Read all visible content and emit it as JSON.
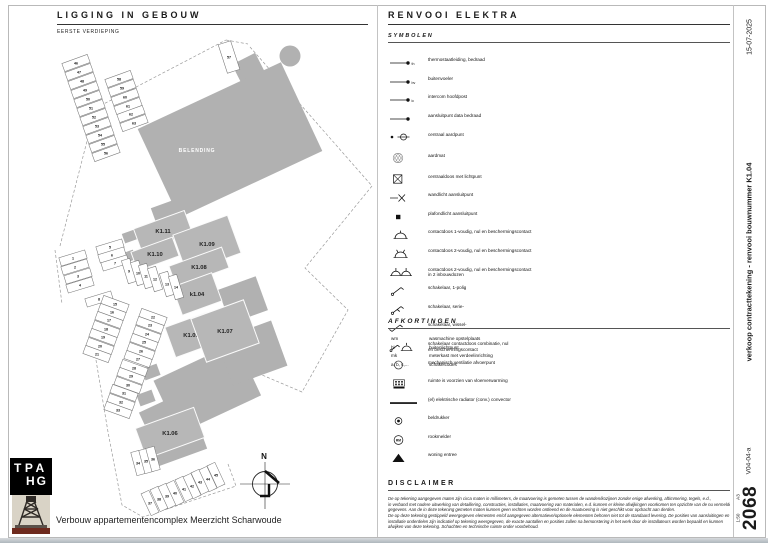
{
  "sheet": {
    "date": "15-07-2025",
    "doc_title": "verkoop contracttekening - renvooi bouwnummer K1.04",
    "version": "V04-04-a",
    "number": "2068",
    "scale": "1:50",
    "paper": "A3",
    "project_title": "Verbouw appartementencomplex Meerzicht Scharwoude",
    "logo_lines": [
      "TPA",
      "HG"
    ]
  },
  "plan": {
    "title": "LIGGING IN GEBOUW",
    "subtitle": "EERSTE VERDIEPING",
    "belending": "BELENDING",
    "north_label": "N",
    "units": [
      {
        "label": "K1.11",
        "x": 163,
        "y": 231,
        "w": 54,
        "h": 24,
        "r": -20
      },
      {
        "label": "K1.09",
        "x": 207,
        "y": 244,
        "w": 58,
        "h": 40,
        "r": -20
      },
      {
        "label": "K1.10",
        "x": 155,
        "y": 254,
        "w": 44,
        "h": 20,
        "r": -20
      },
      {
        "label": "K1.08",
        "x": 199,
        "y": 267,
        "w": 56,
        "h": 22,
        "r": -20
      },
      {
        "label": "k1.04",
        "x": 197,
        "y": 294,
        "w": 42,
        "h": 30,
        "r": -20
      },
      {
        "label": "K1.05",
        "x": 191,
        "y": 335,
        "w": 44,
        "h": 32,
        "r": -20
      },
      {
        "label": "K1.07",
        "x": 225,
        "y": 331,
        "w": 56,
        "h": 46,
        "r": -20
      },
      {
        "label": "K1.06",
        "x": 170,
        "y": 433,
        "w": 62,
        "h": 32,
        "r": -20
      }
    ],
    "stalls": [
      [
        "46",
        76,
        63,
        -20
      ],
      [
        "47",
        79,
        72,
        -20
      ],
      [
        "48",
        82,
        81,
        -20
      ],
      [
        "49",
        85,
        90,
        -20
      ],
      [
        "50",
        88,
        99,
        -20
      ],
      [
        "51",
        91,
        108,
        -20
      ],
      [
        "52",
        94,
        117,
        -20
      ],
      [
        "53",
        97,
        126,
        -20
      ],
      [
        "54",
        100,
        135,
        -20
      ],
      [
        "55",
        103,
        144,
        -20
      ],
      [
        "56",
        106,
        153,
        -20
      ],
      [
        "57",
        229,
        57,
        72,
        30,
        13
      ],
      [
        "58",
        119,
        79,
        -20
      ],
      [
        "59",
        122,
        88,
        -20
      ],
      [
        "60",
        125,
        97,
        -20
      ],
      [
        "61",
        128,
        106,
        -20
      ],
      [
        "62",
        131,
        114,
        -20
      ],
      [
        "63",
        134,
        123,
        -20
      ],
      [
        "1",
        73,
        258,
        -17
      ],
      [
        "2",
        75,
        267,
        -17
      ],
      [
        "3",
        78,
        276,
        -17
      ],
      [
        "4",
        80,
        285,
        -17
      ],
      [
        "5",
        110,
        247,
        -17
      ],
      [
        "6",
        112,
        255,
        -17
      ],
      [
        "7",
        115,
        263,
        -17
      ],
      [
        "8",
        99,
        299,
        -17
      ],
      [
        "9",
        129,
        271,
        73,
        24,
        8.6
      ],
      [
        "10",
        138,
        273,
        73,
        24,
        8.6
      ],
      [
        "11",
        146,
        276,
        73,
        24,
        8.6
      ],
      [
        "12",
        155,
        279,
        73,
        24,
        8.6
      ],
      [
        "13",
        167,
        284,
        73,
        24,
        8.6
      ],
      [
        "14",
        176,
        287,
        73,
        24,
        8.6
      ],
      [
        "15",
        115,
        304,
        20
      ],
      [
        "16",
        112,
        312,
        20
      ],
      [
        "17",
        109,
        320,
        20
      ],
      [
        "18",
        106,
        329,
        20
      ],
      [
        "19",
        103,
        337,
        20
      ],
      [
        "20",
        100,
        346,
        20
      ],
      [
        "21",
        97,
        354,
        20
      ],
      [
        "22",
        153,
        317,
        20
      ],
      [
        "23",
        150,
        325,
        20
      ],
      [
        "24",
        147,
        334,
        20
      ],
      [
        "25",
        144,
        342,
        20
      ],
      [
        "26",
        141,
        351,
        20
      ],
      [
        "27",
        138,
        359,
        20
      ],
      [
        "28",
        134,
        368,
        20
      ],
      [
        "29",
        131,
        376,
        20
      ],
      [
        "30",
        128,
        385,
        20
      ],
      [
        "31",
        124,
        393,
        20
      ],
      [
        "32",
        121,
        402,
        20
      ],
      [
        "33",
        118,
        410,
        20
      ],
      [
        "34",
        138,
        463,
        75,
        24,
        8.6
      ],
      [
        "35",
        146,
        461,
        75,
        24,
        8.6
      ],
      [
        "36",
        153,
        459,
        75,
        24,
        8.6
      ],
      [
        "37",
        150,
        503,
        65,
        24,
        8.6
      ],
      [
        "38",
        159,
        499,
        65,
        24,
        8.6
      ],
      [
        "39",
        167,
        496,
        65,
        24,
        8.6
      ],
      [
        "40",
        175,
        493,
        65,
        24,
        8.6
      ],
      [
        "41",
        184,
        489,
        65,
        24,
        8.6
      ],
      [
        "42",
        192,
        486,
        65,
        24,
        8.6
      ],
      [
        "43",
        200,
        482,
        65,
        24,
        8.6
      ],
      [
        "44",
        208,
        479,
        65,
        24,
        8.6
      ],
      [
        "45",
        216,
        475,
        65,
        24,
        8.6
      ]
    ]
  },
  "legend": {
    "title": "RENVOOI ELEKTRA",
    "symbols_title": "SYMBOLEN",
    "items": [
      {
        "icon": "wire",
        "tag": "th",
        "label": "thermostaatleiding, bedraad"
      },
      {
        "icon": "wire",
        "tag": "bv",
        "label": "buitenvoeler"
      },
      {
        "icon": "wire",
        "tag": "ic",
        "label": "intercom hoofdpost"
      },
      {
        "icon": "wire",
        "tag": "",
        "label": "aansluitpunt data bedraad"
      },
      {
        "icon": "earth",
        "label": "centraal aardpunt"
      },
      {
        "icon": "mat",
        "label": "aardmat",
        "gap": true
      },
      {
        "icon": "boxx",
        "label": "centraaldoos met lichtpunt",
        "gap": true
      },
      {
        "icon": "wall",
        "label": "wandlicht aansluitpunt"
      },
      {
        "icon": "sq",
        "label": "plafondlicht aansluitpunt"
      },
      {
        "icon": "socket1",
        "label": "contactdoos 1-voudig, nul en beschermingscontact"
      },
      {
        "icon": "socket2",
        "label": "contactdoos 2-voudig, nul en beschermingscontact"
      },
      {
        "icon": "socket2b",
        "label": "contactdoos 2-voudig, nul en beschermingscontact\nin 2 inbouwdozen"
      },
      {
        "icon": "sw1",
        "label": "schakelaar, 1-polig"
      },
      {
        "icon": "swserie",
        "label": "schakelaar, serie-"
      },
      {
        "icon": "swwissel",
        "label": "schakelaar, wissel-"
      },
      {
        "icon": "swcombi",
        "label": "schakelaar contactdoos combinatie, nul\nen beschermingscontact"
      },
      {
        "icon": "vent",
        "label": "mechanisch ventilatie afvoerpunt"
      },
      {
        "icon": "floorheat",
        "label": "ruimte is voorzien van vloerverwarming"
      },
      {
        "icon": "radiator",
        "label": "(el) elektrische radiator (conv.) convector"
      },
      {
        "icon": "bell",
        "label": "beldrukker"
      },
      {
        "icon": "smoke",
        "label": "rookmelder",
        "smoke_text": "RM"
      },
      {
        "icon": "entry",
        "label": "woning entree"
      }
    ],
    "abbr_title": "AFKORTINGEN",
    "abbreviations": [
      {
        "key": "wm",
        "value": "wasmachine opstelplaats"
      },
      {
        "key": "bl",
        "value": "buitenlichtpunt"
      },
      {
        "key": "mk",
        "value": "meterkast met verdeelinrichting"
      },
      {
        "key": "a, b, c,...",
        "value": "schakelcodes"
      }
    ],
    "disclaimer_title": "DISCLAIMER",
    "disclaimer_lines": [
      "De op tekening aangegeven maten zijn circa maten in millimeters, de maatvoering is gemeten tussen de wanden/kozijnen zonder enige afwerking, aftimmering, tegels, e.d.,",
      "in verband met nadere uitwerking van detaillering, constructies, installaties, maatvoering van materialen, e.d. kunnen er kleine afwijkingen voorkomen ten opzichte van de nu vermelde",
      "gegevens. Aan de in deze tekening gemeten maten kunnen geen rechten worden ontleend en de maatvoering is niet geschikt voor opdracht aan derden.",
      "De op deze tekening gestippeld weergegeven elementen en/of aangegeven alternatieve/optionele elementen behoren niet tot de standaard levering. De posities van aansluitingen en",
      "installatie onderdelen zijn indicatief op tekening weergegeven, de exacte aantallen en posities zullen na bemonstering in het werk door de installateurs worden bepaald en kunnen",
      "afwijken van deze tekening. Schachten en technische ruimte onder voorbehoud."
    ]
  }
}
